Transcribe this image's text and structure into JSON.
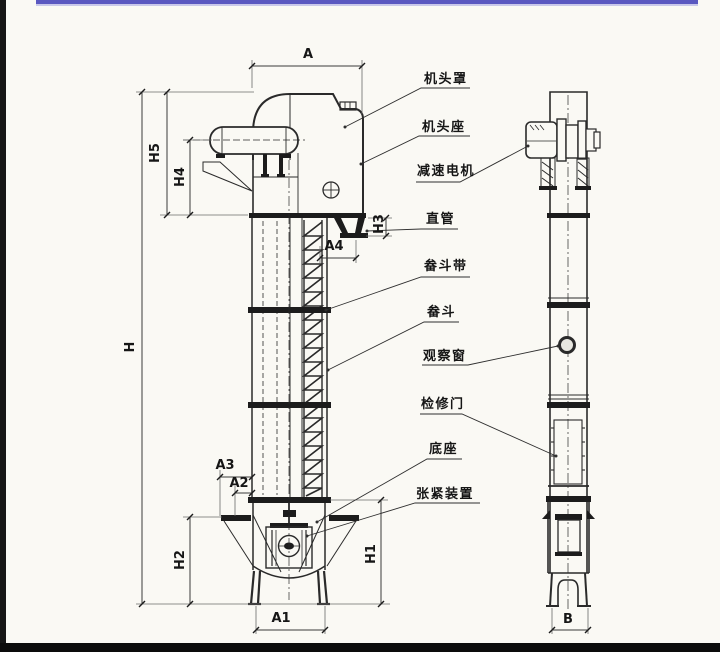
{
  "drawing_type": "bucket-elevator technical drawing, front view and side view",
  "colors": {
    "paper": "#faf9f4",
    "line": "#2a2a2a",
    "top_bar": "#5a58c0",
    "bottom_bar": "#0c0c0c"
  },
  "labels": {
    "parts": [
      {
        "id": "head-cover",
        "text": "机头罩"
      },
      {
        "id": "head-seat",
        "text": "机头座"
      },
      {
        "id": "gear-motor",
        "text": "减速电机"
      },
      {
        "id": "straight-pipe",
        "text": "直管"
      },
      {
        "id": "bucket-belt",
        "text": "畚斗带"
      },
      {
        "id": "bucket",
        "text": "畚斗"
      },
      {
        "id": "observation-window",
        "text": "观察窗"
      },
      {
        "id": "inspection-door",
        "text": "检修门"
      },
      {
        "id": "base",
        "text": "底座"
      },
      {
        "id": "tensioning-device",
        "text": "张紧装置"
      }
    ],
    "dims": {
      "a": "A",
      "h5": "H5",
      "h4": "H4",
      "h3": "H3",
      "a4": "A4",
      "h": "H",
      "a3": "A3",
      "a2": "A2",
      "h2": "H2",
      "h1": "H1",
      "a1": "A1",
      "b": "B"
    }
  }
}
